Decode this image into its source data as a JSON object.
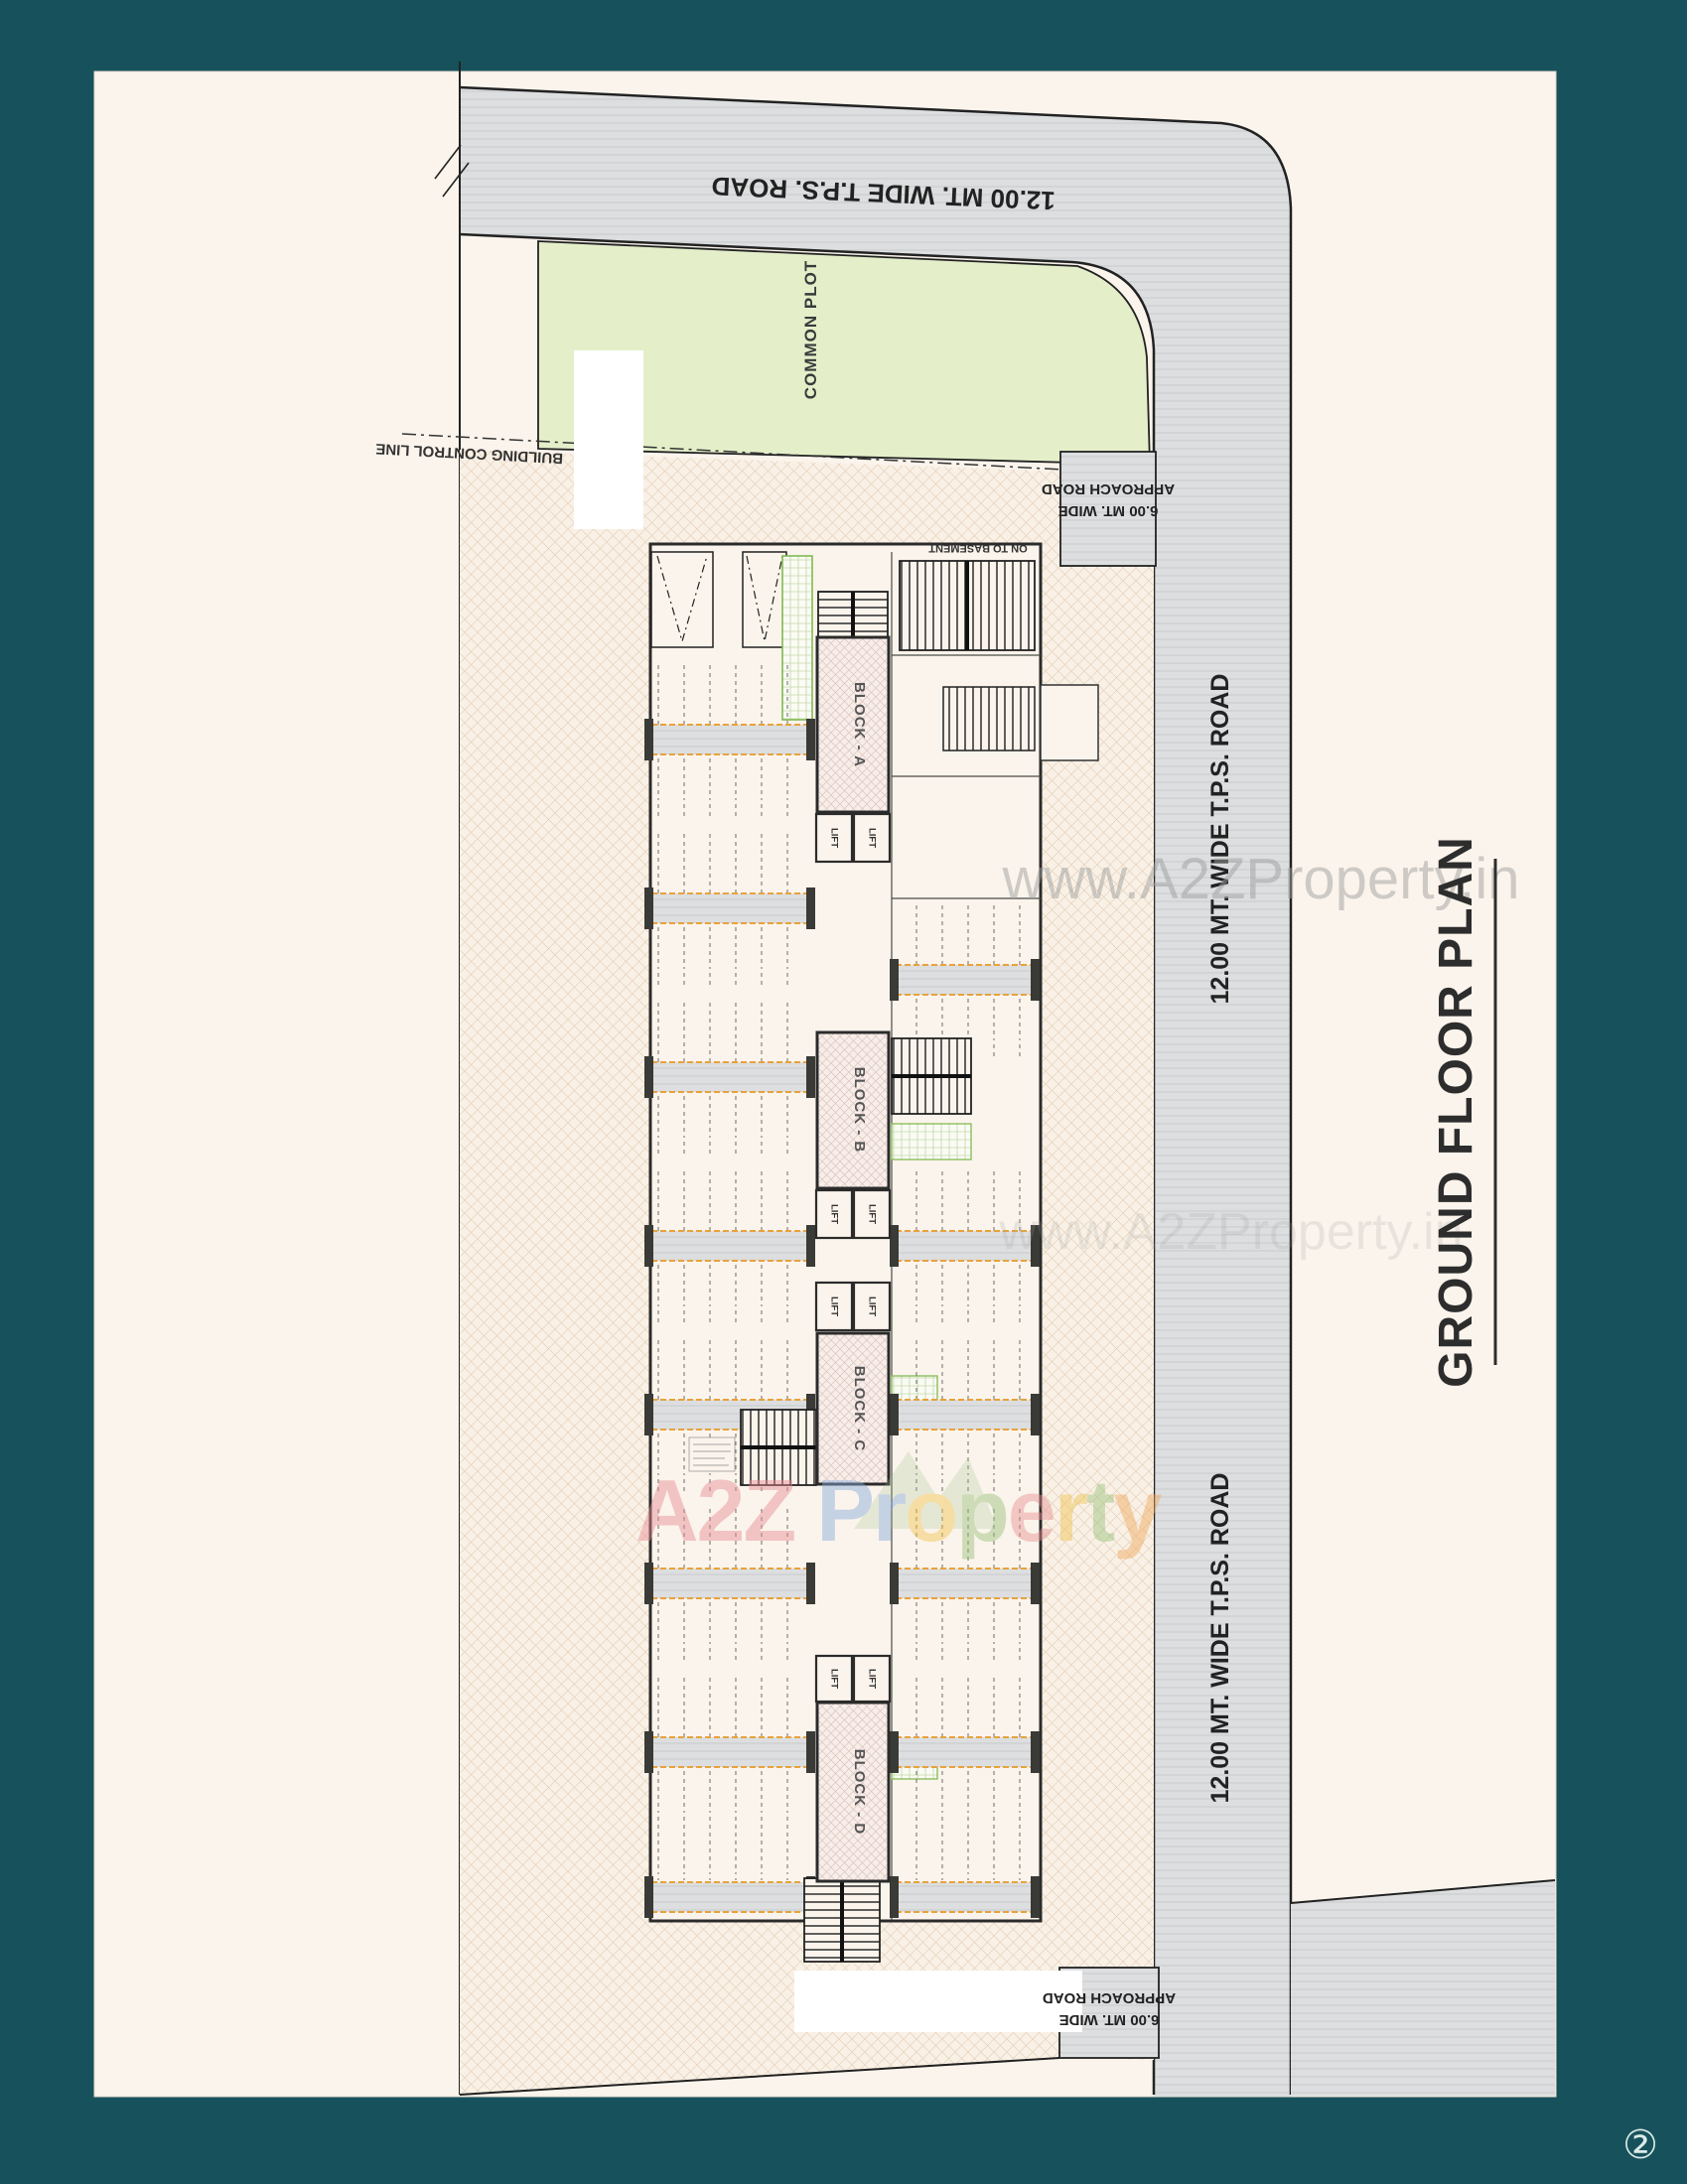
{
  "document": {
    "page_badge": "②"
  },
  "title": {
    "text": "GROUND FLOOR PLAN"
  },
  "roads": {
    "tps_top": "12.00 MT. WIDE T.P.S. ROAD",
    "tps_right_upper": "12.00 MT. WIDE T.P.S. ROAD",
    "tps_right_lower": "12.00 MT. WIDE T.P.S. ROAD",
    "approach_top": {
      "line1": "6.00 MT. WIDE",
      "line2": "APPROACH ROAD"
    },
    "approach_bottom": {
      "line1": "6.00 MT. WIDE",
      "line2": "APPROACH ROAD"
    }
  },
  "site": {
    "common_plot": "COMMON PLOT",
    "building_control_line": "BUILDING CONTROL LINE",
    "on_to_basement": "ON TO BASEMENT"
  },
  "blocks": [
    {
      "label": "BLOCK - A"
    },
    {
      "label": "BLOCK - B"
    },
    {
      "label": "BLOCK - C"
    },
    {
      "label": "BLOCK - D"
    }
  ],
  "lift": "LIFT",
  "watermarks": {
    "brand_a2z": "A2Z",
    "brand_property_letters": [
      "P",
      "r",
      "o",
      "p",
      "e",
      "r",
      "t",
      "y"
    ],
    "url": "www.A2ZProperty.in",
    "url_faint": "www.A2ZProperty.in"
  },
  "colors": {
    "page_teal": "#17525c",
    "paper": "#fbf4ec",
    "road_gray": "#dcdedf",
    "common_plot_green": "#e4efca",
    "block_hatch_pink": "#f7eeea",
    "orange_dash": "#e8a23c",
    "wall_ink": "#2b2b2b",
    "title_ink": "#2d2d2d"
  }
}
